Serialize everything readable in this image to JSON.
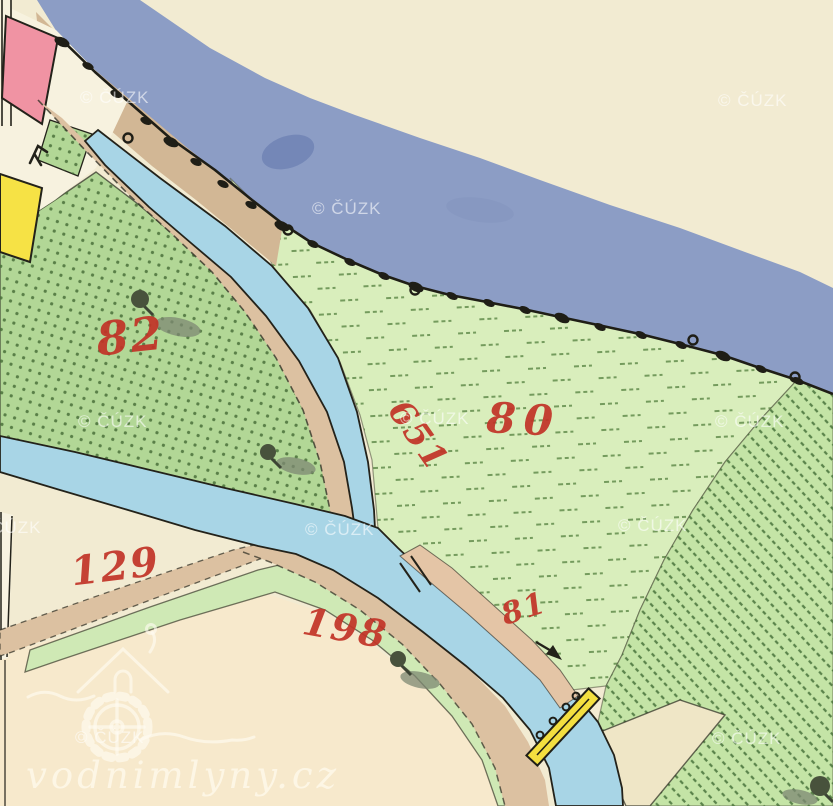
{
  "map": {
    "title": "Historical cadastral map sheet (imperial imprint style)",
    "watermarks": {
      "text": "© ČÚZK",
      "positions": [
        [
          80,
          103
        ],
        [
          718,
          106
        ],
        [
          312,
          214
        ],
        [
          78,
          427
        ],
        [
          400,
          424
        ],
        [
          715,
          427
        ],
        [
          305,
          535
        ],
        [
          618,
          531
        ],
        [
          75,
          743
        ],
        [
          712,
          744
        ],
        [
          -28,
          533
        ]
      ]
    },
    "logo": {
      "text": "vodnimlyny.cz"
    },
    "parcel_numbers": [
      {
        "text": "82",
        "x": 132,
        "y": 352,
        "size": 46,
        "rot": -6,
        "ls": 2
      },
      {
        "text": "80",
        "x": 523,
        "y": 434,
        "size": 42,
        "rot": 3,
        "ls": 8
      },
      {
        "text": "651",
        "x": 409,
        "y": 442,
        "size": 34,
        "rot": 55,
        "ls": 2
      },
      {
        "text": "81",
        "x": 527,
        "y": 618,
        "size": 30,
        "rot": -18,
        "ls": 2
      },
      {
        "text": "129",
        "x": 117,
        "y": 580,
        "size": 40,
        "rot": -7,
        "ls": 2
      },
      {
        "text": "198",
        "x": 343,
        "y": 641,
        "size": 38,
        "rot": 10,
        "ls": 2
      }
    ],
    "colors": {
      "background": "#f2ebd2",
      "bottom_field_cream": "#f7e9cc",
      "river_slate": "#8c9dc5",
      "river_dark_patch": "#7487b7",
      "stream_blue": "#a8d5e6",
      "road_tan": "#dcc1a1",
      "bank_strip_tan": "#d2b795",
      "embankment_tan": "#e4c5a6",
      "meadow_light_green": "#d9eebc",
      "meadow_medium_green": "#b2d796",
      "meadow_hatched_green": "#c4e4a6",
      "green_strip": "#cfe9b5",
      "building_pink": "#f093a3",
      "building_yellow": "#f6e245",
      "bridge_yellow": "#f3df3f",
      "parcel_number_red": "#c23327",
      "outline_black": "#23221a",
      "watermark": "rgba(255,255,255,0.58)"
    },
    "symbols": {
      "trees": [
        {
          "x": 140,
          "y": 299,
          "r": 9,
          "sx": 178,
          "sy": 327,
          "srx": 23,
          "sry": 9
        },
        {
          "x": 268,
          "y": 452,
          "r": 8,
          "sx": 296,
          "sy": 466,
          "srx": 20,
          "sry": 8
        },
        {
          "x": 398,
          "y": 659,
          "r": 8,
          "sx": 420,
          "sy": 680,
          "srx": 20,
          "sry": 8
        },
        {
          "x": 820,
          "y": 786,
          "r": 10,
          "sx": 800,
          "sy": 797,
          "srx": 18,
          "sry": 7
        }
      ],
      "bank_bushes": [
        [
          62,
          42
        ],
        [
          88,
          66
        ],
        [
          116,
          94
        ],
        [
          146,
          121
        ],
        [
          171,
          142
        ],
        [
          196,
          162
        ],
        [
          223,
          184
        ],
        [
          251,
          205
        ],
        [
          282,
          226
        ],
        [
          313,
          244
        ],
        [
          350,
          262
        ],
        [
          384,
          276
        ],
        [
          416,
          287
        ],
        [
          452,
          296
        ],
        [
          489,
          303
        ],
        [
          525,
          310
        ],
        [
          562,
          318
        ],
        [
          600,
          327
        ],
        [
          641,
          335
        ],
        [
          681,
          345
        ],
        [
          723,
          356
        ],
        [
          761,
          369
        ],
        [
          798,
          381
        ]
      ],
      "bank_loops": [
        [
          128,
          138
        ],
        [
          288,
          230
        ],
        [
          415,
          290
        ],
        [
          693,
          340
        ],
        [
          795,
          377
        ]
      ],
      "bridge_posts": [
        [
          540,
          735
        ],
        [
          553,
          721
        ],
        [
          566,
          707
        ],
        [
          576,
          696
        ]
      ]
    }
  }
}
